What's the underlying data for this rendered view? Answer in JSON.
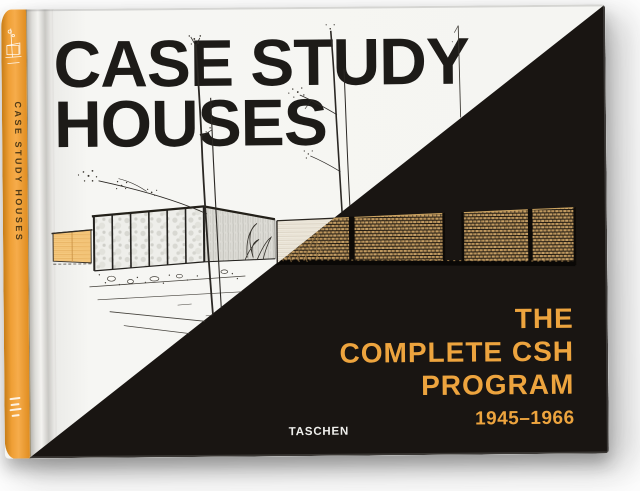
{
  "cover": {
    "title": {
      "line1": "CASE STUDY",
      "line2": "HOUSES"
    },
    "subtitle": {
      "line1": "THE",
      "line2": "COMPLETE CSH",
      "line3": "PROGRAM"
    },
    "years": "1945–1966",
    "publisher": "TASCHEN"
  },
  "spine": {
    "title": "CASE STUDY HOUSES"
  },
  "artwork": {
    "name": "case-study-house-line-drawing",
    "description": "architectural line drawing of a modernist glass pavilion with thin trees and a long brick wall, inverted to tan on the black half"
  },
  "colors": {
    "cover_white": "#f5f5f2",
    "cover_black": "#191512",
    "accent_orange": "#eda43e",
    "spine_orange": "#ef9f35",
    "title_black": "#1d1b18",
    "brick_tan": "#c29b60",
    "pale_wall": "#f6c97f"
  }
}
